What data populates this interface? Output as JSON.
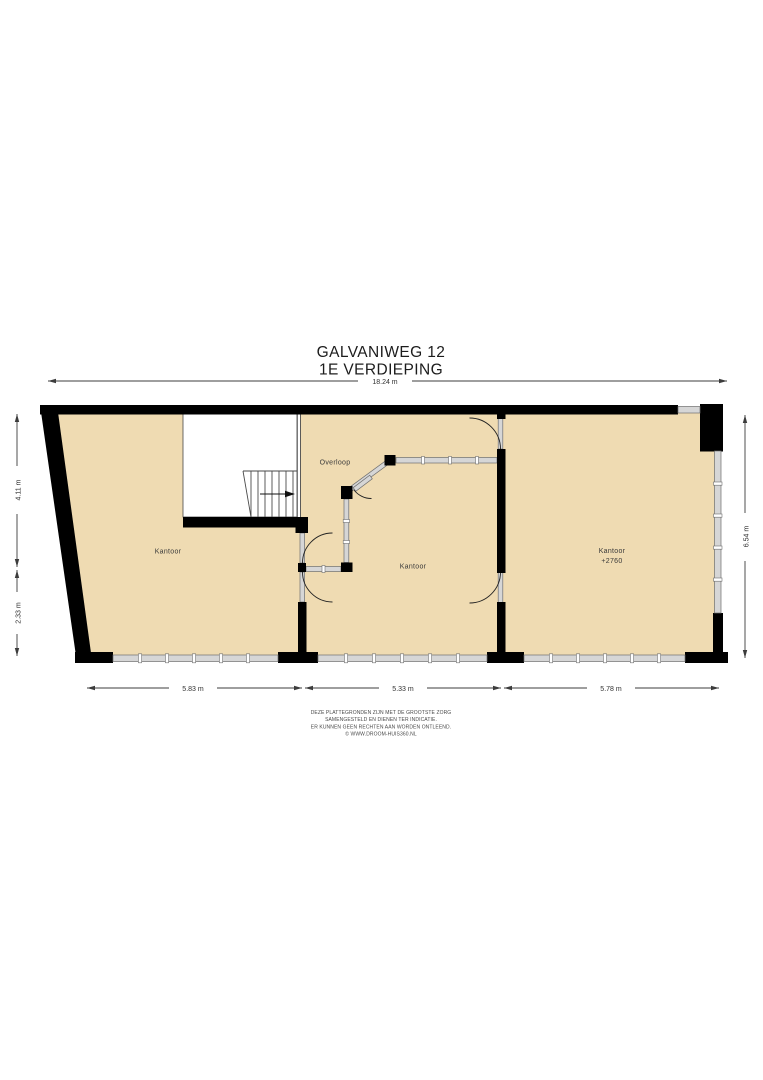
{
  "title": {
    "line1": "GALVANIWEG 12",
    "line2": "1E VERDIEPING"
  },
  "floorplan": {
    "rooms": [
      {
        "name": "kantoor-left",
        "label": "Kantoor"
      },
      {
        "name": "overloop",
        "label": "Overloop"
      },
      {
        "name": "kantoor-middle",
        "label": "Kantoor"
      },
      {
        "name": "kantoor-right",
        "label": "Kantoor",
        "sublabel": "+2760"
      }
    ],
    "colors": {
      "floor": "#efdbb2",
      "wall": "#000000",
      "window": "#d6d6d6",
      "background": "#ffffff"
    }
  },
  "dimensions": {
    "top": "18.24 m",
    "left_upper": "4.11 m",
    "left_lower": "2.33 m",
    "right": "6.54 m",
    "bottom_left": "5.83 m",
    "bottom_middle": "5.33 m",
    "bottom_right": "5.78 m"
  },
  "disclaimer": {
    "line1": "DEZE PLATTEGRONDEN ZIJN MET DE GROOTSTE ZORG",
    "line2": "SAMENGESTELD EN DIENEN TER INDICATIE.",
    "line3": "ER KUNNEN GEEN RECHTEN AAN WORDEN ONTLEEND.",
    "line4": "© WWW.DROOM-HUIS360.NL"
  }
}
